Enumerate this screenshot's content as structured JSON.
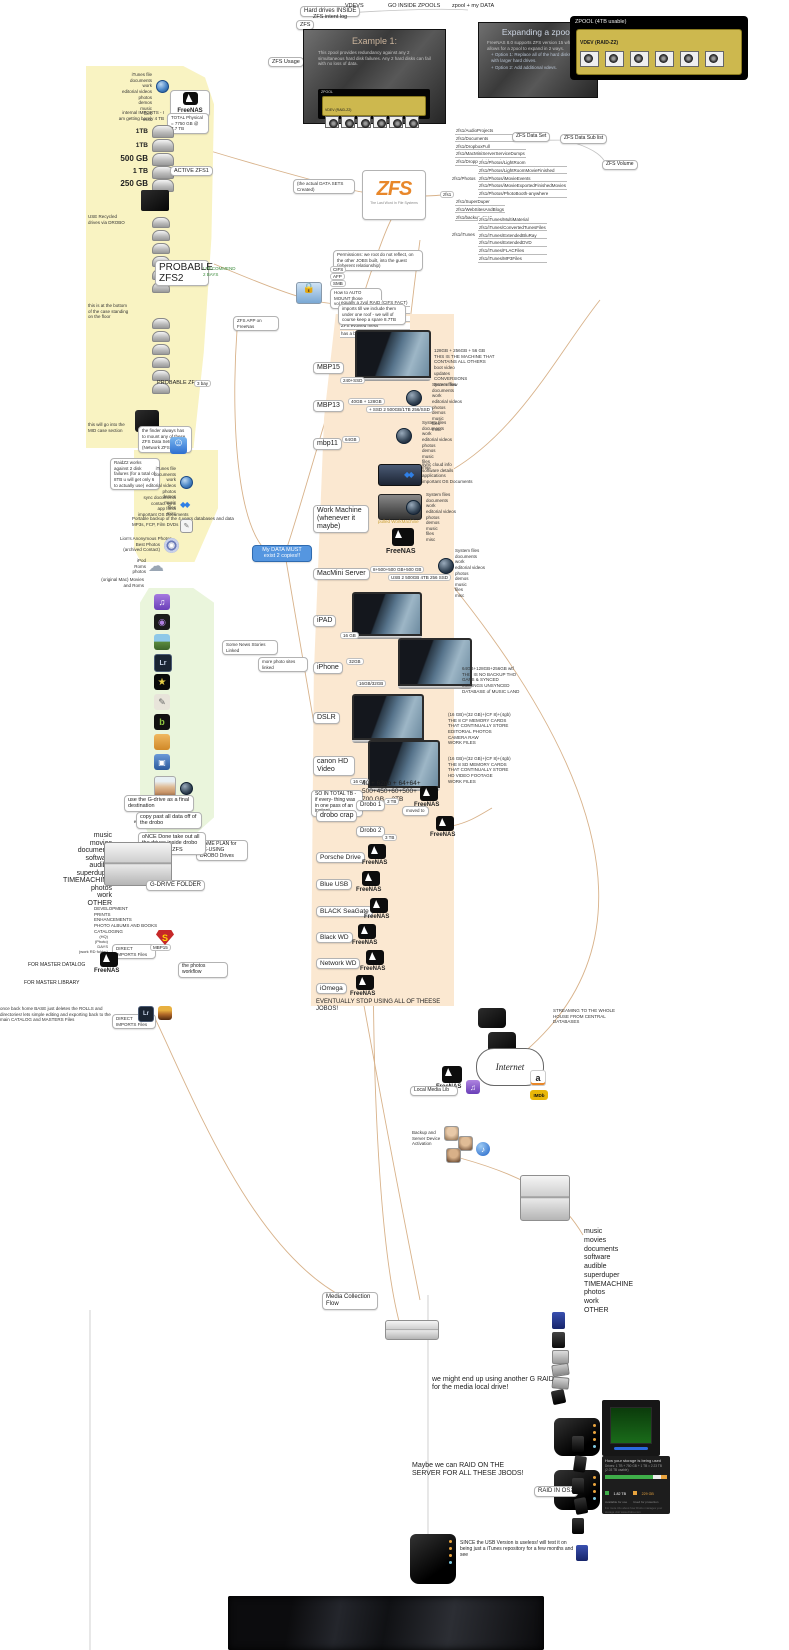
{
  "colors": {
    "region_yellow": "#f9f3c2",
    "region_peach": "#fbe8d1",
    "region_green": "#eaf5dc",
    "node_blue": "#5596e0",
    "vdev_yellow": "#cdb84e",
    "freenas_black": "#0d0d0d",
    "connector_tan": "#d8b28a",
    "status_green": "#3fae49",
    "status_orange": "#e8a33d"
  },
  "top": {
    "hard_drives_inside": "Hard drives INSIDE",
    "vdevs": "VDEVS",
    "go_inside_zpools": "GO INSIDE ZPOOLS",
    "zpool_my_data": "zpool + my DATA",
    "zfs_intent_log": "ZFS intent log",
    "zfs": "ZFS",
    "zfs_usage": "ZFS Usage",
    "slide1": {
      "title": "Example 1:",
      "body": "This zpool provides redundancy against any 2 simultaneous hard disk failures.  Any 2 hard disks can fail with no loss of data.",
      "zpool_label": "ZPOOL",
      "vdev_label": "VDEV (RAID-Z2)"
    },
    "slide2": {
      "title": "Expanding a zpool.",
      "line1": "FreeNAS 8.0 supports ZFS version 15 which only allows for a zpool to expand in 2 ways.",
      "line2": "+ Option 1:  Replace all of the hard disks in a vdev with larger hard drives.",
      "line3": "+ Option 2:  Add additional vdevs."
    },
    "zpool_box": {
      "title": "ZPOOL (4TB usable)",
      "vdev_label": "VDEV (RAID-Z2)"
    }
  },
  "left": {
    "file_list": [
      "iTunes file",
      "documents",
      "work",
      "editorial videos",
      "photos",
      "demos",
      "music",
      "files",
      "misc"
    ],
    "freenas": "FreeNAS",
    "imports_note": "internal IMPORTS - I am getting barely 4 TB",
    "total_note": "TOTAL Physical = 7750 GB @ 7.7 TB",
    "d1": "1TB",
    "d2": "1TB",
    "d3": "500 GB",
    "d4": "1 TB",
    "d4_tag": "ACTIVE ZFS1",
    "d5": "250 GB",
    "recycled_note": "USE Recycled drives via DROBO",
    "probable_zfs2": "PROBABLE ZFS2",
    "recommend_note": "I RECOMMEND 2 BAYS",
    "bottom_note": "this is at the bottom of the case standing on the floor",
    "probable_zfs3": "PROBABLE ZFS3",
    "zfs3_tag": "3 bay",
    "mid_case_note": "this will go into the MID case section",
    "finder_note": "the finder always has to mount any of these ZFS Data Sets (Network ZFSNAS)",
    "raidz_note": "RaidZ2 works against 2 disk failures (for a total of 8TB u will get only 6 to actually use)",
    "dropbox_list": [
      "sync documents",
      "contact sync",
      "app fonts",
      "important OS Documents"
    ],
    "textedit_list": [
      "Portable backup of the 4 years databases and data",
      "MP3s, FCP, Film DVDs"
    ],
    "dvd_list": [
      "Lion's Anonymous Photos",
      "Best Photos",
      "(archived Contact)"
    ],
    "cloud_list": [
      "iPod",
      "Roms",
      "photos"
    ],
    "cloud_caption": "(original Mac) Movies and Roms"
  },
  "apps": {
    "label1": "Some News Stories Linked",
    "label2": "more photo sites linked",
    "face_list": [
      "info",
      "blog",
      "articles",
      "wiki",
      "elements"
    ]
  },
  "core": {
    "data_node": "My DATA MUST exist 2 copies!!",
    "created_label": "(the actual DATA SETS Created)",
    "zfs_logo": "ZFS",
    "zfs_caption": "The Last Word In File Systems",
    "zfs1_tag": "zfs1",
    "lbl_data_set": "ZFS Data Set",
    "lbl_data_sub": "ZFS Data Sub list",
    "lbl_volume": "ZFS Volume",
    "datasets_a": [
      "zfs1/AudioProjects",
      "zfs1/Documents",
      "zfs1/DropboxFull",
      "zfs1/MacMiniServerServiceDumps",
      "zfs1/DroppedVideoOnly"
    ],
    "photos_parent": "zfs1/Photos",
    "photos_children": [
      "zfs1/Photos/LightRoom",
      "zfs1/Photos/LightRoomMovieFinished",
      "zfs1/Photos/iMovieEvents",
      "zfs1/Photos/iMovieExportedFinishedMovies",
      "zfs1/Photos/PhotoBooth-anywhere"
    ],
    "datasets_b": [
      "zfs1/SuperDuper",
      "zfs1/WebSitesAndBlogs",
      "zfs1/backup_zee1"
    ],
    "itunes_parent": "zfs1/iTunes",
    "itunes_children": [
      "zfs1/iTunes/MultiMaterial",
      "zfs1/iTunes/ConvertedTunesFiles",
      "zfs1/iTunes/ExtendedBluRay",
      "zfs1/iTunes/ExtendedDVD",
      "zfs1/iTunes/FLACFiles",
      "zfs1/iTunes/MP3Files"
    ],
    "zee1_tag": "zee1",
    "permissions_note": "Permissions: we root do not reflect, on the other JOBS built, into the guest (inherent relationship)",
    "protocols": [
      "CIFS",
      "AFP",
      "SMB"
    ],
    "automount_note": "How to AUTO MOUNT those volumes in MAC",
    "automount_lines": [
      "equally a zvol RAID (CIFS FACT)",
      "PLUGINS 7 seconds fix",
      "a demo DASHBOARD",
      "ZFS evolved mess",
      "has a balance & amounts to BErA"
    ],
    "zfs_app_label": "ZFS APP on FreeNas"
  },
  "devices": {
    "top_note": "imports till we include them under one roof - we will of course keep a spare 8.7TB",
    "mbp15": "MBP15",
    "mbp15_tag": "240+SSD",
    "mbp15_list": [
      "128GB + 256GB + 56 GB",
      "THIS IS THE MACHINE THAT",
      "CONTAINS ALL OTHERS",
      "boot video",
      "updates",
      "CONVERSIONS",
      "Screen flow"
    ],
    "mbp13": "MBP13",
    "mbp13_tag1": "40GB + 128GB",
    "mbp13_tag2": "+ SSD 2 500GB/1TB 256/SSD",
    "mbp11": "mbp11",
    "mbp11_tag": "64GB",
    "machine_list": [
      "System files",
      "documents",
      "work",
      "editorial videos",
      "photos",
      "demos",
      "music",
      "files",
      "misc"
    ],
    "work_machine": "Work Machine (whenever it maybe)",
    "work_dropbox_list": [
      "sync cloud info",
      "software details",
      "applications",
      "important OS Documents"
    ],
    "work_disk_caption": "pulled WorkMachine",
    "freenas_label": "FreeNAS",
    "macmini": "MacMini Server",
    "macmini_tag1": "8+500+500 GB+500 GB",
    "macmini_tag2": "USB 2 500GB 4TB 256 SSD",
    "ipad": "iPAD",
    "ipad_tag": "16 GB",
    "iphone": "iPhone",
    "iphone_tag1": "32GB",
    "iphone_tag2": "16GB/32GB",
    "iphone_list": [
      "64GB+128GB+256GB wtf",
      "THIS IS NO BACKUP THO",
      "GAPS & SYNCED",
      "MUSINGS UNSYNCED",
      "DATABASE of MUSIC LAND"
    ],
    "dslr": "DSLR",
    "dslr_list": [
      "(16 GB)+(32 GB)+(CF 8)+(4gb)",
      "THE 8 CF MEMORY CARDS",
      "THAT CONTINUALLY STORE",
      "EDITORIAL PHOTOS",
      "CAMERA RAW",
      "WORK FILES"
    ],
    "canon": "canon HD Video",
    "canon_tag": "16 GB",
    "canon_list": [
      "(16 GB)+(32 GB)+(CF 8)+(4gb)",
      "THE 8 SD MEMORY CARDS",
      "THAT CONTINUALLY STORE",
      "HD VIDEO FOOTAGE",
      "WORK FILES"
    ],
    "total_note": "SO IN TOTAL TB -  if every- thing was in one pass of an instant",
    "total_math": "40 + 62gb + 64+64+ 500+450+60+500+ 700 GB = 3TB",
    "drobo_crap": "drobo crap",
    "drobo1": "Drobo 1",
    "drobo1_tag": "3 TB",
    "moved_to": "moved to",
    "drobo2": "Drobo 2",
    "drobo2_tag": "3 TB",
    "game_plan": "GAME PLAN for RE-USING DROBO Drives",
    "jbod1": "Porsche Drive",
    "jbod2": "Blue USB",
    "jbod3": "BLACK SeaGate",
    "jbod4": "Black WD",
    "jbod5": "Network WD",
    "jbod6": "iOmega",
    "footer": "EVENTUALLY STOP USING ALL OF THEESE JOBOS!"
  },
  "gdrive": {
    "step1": "use the G-drive as a final destination",
    "step2": "copy past all data off of the drobo",
    "step3": "oNCE Done take out all the drives inside drobo and into the ZFS",
    "list": [
      "music",
      "movies",
      "documents",
      "software",
      "audible",
      "superduper",
      "TIMEMACHINE",
      "photos",
      "work",
      "OTHER"
    ],
    "folder": "G-DRIVE FOLDER"
  },
  "photoflow": {
    "tasks": [
      "DEVELOPMENT",
      "PRINTS",
      "ENHANCEMENTS",
      "PHOTO ALBUMS AND BOOKS",
      "CATALOGING"
    ],
    "hq_list": [
      "(HQ)",
      "(Photo)",
      "DAYS",
      "(work RD folder)"
    ],
    "direct_imports": "DIRECT IMPORTS Files",
    "mbp15_tag": "MBP15",
    "freenas": "FreeNAS",
    "master_datalog": "FOR MASTER DATALOG",
    "master_library": "FOR MASTER LIBRARY",
    "workflow": "the photos workflow",
    "home_note": "once back home BASE just deletes the ROLLS and directories! lets simple editing and exporting back to the main CATALOG and MASTERS Files",
    "direct_imports2": "DIRECT IMPORTS Files"
  },
  "media": {
    "streaming_note": "STREAMING TO THE WHOLE HOUSE FROM CENTRAL DATABASES",
    "internet": "Internet",
    "freenas": "FreeNAS",
    "local_media": "Local Media Lib",
    "backup_note": "Backup and Server Device Activation",
    "list": [
      "music",
      "movies",
      "documents",
      "software",
      "audible",
      "superduper",
      "TIMEMACHINE",
      "photos",
      "work",
      "OTHER"
    ],
    "collection_flow": "Media Collection Flow",
    "graid_note": "we might end up using another G RAID for the media local drive!",
    "drobo_panel": {
      "title": "How your storage is being used",
      "drives_line": "Drives: 1 TB + 750 GB + 1 TB = 2.23 TB (2.03 TB usable)",
      "legend": [
        {
          "value": "1.82 TB",
          "label": "Available for use"
        },
        {
          "value": "229 GB",
          "label": "Used for protection"
        }
      ],
      "footnote": "For more info about how Drobo manages your storage visit www.drobo.com"
    },
    "raid_note": "Maybe we can RAID ON THE SERVER FOR ALL THESE JBODS!",
    "raid_osx": "RAID IN OSX",
    "usb_note": "SINCE the USB Version is useless! will test it on being just a iTunes repository for a few months and see"
  }
}
